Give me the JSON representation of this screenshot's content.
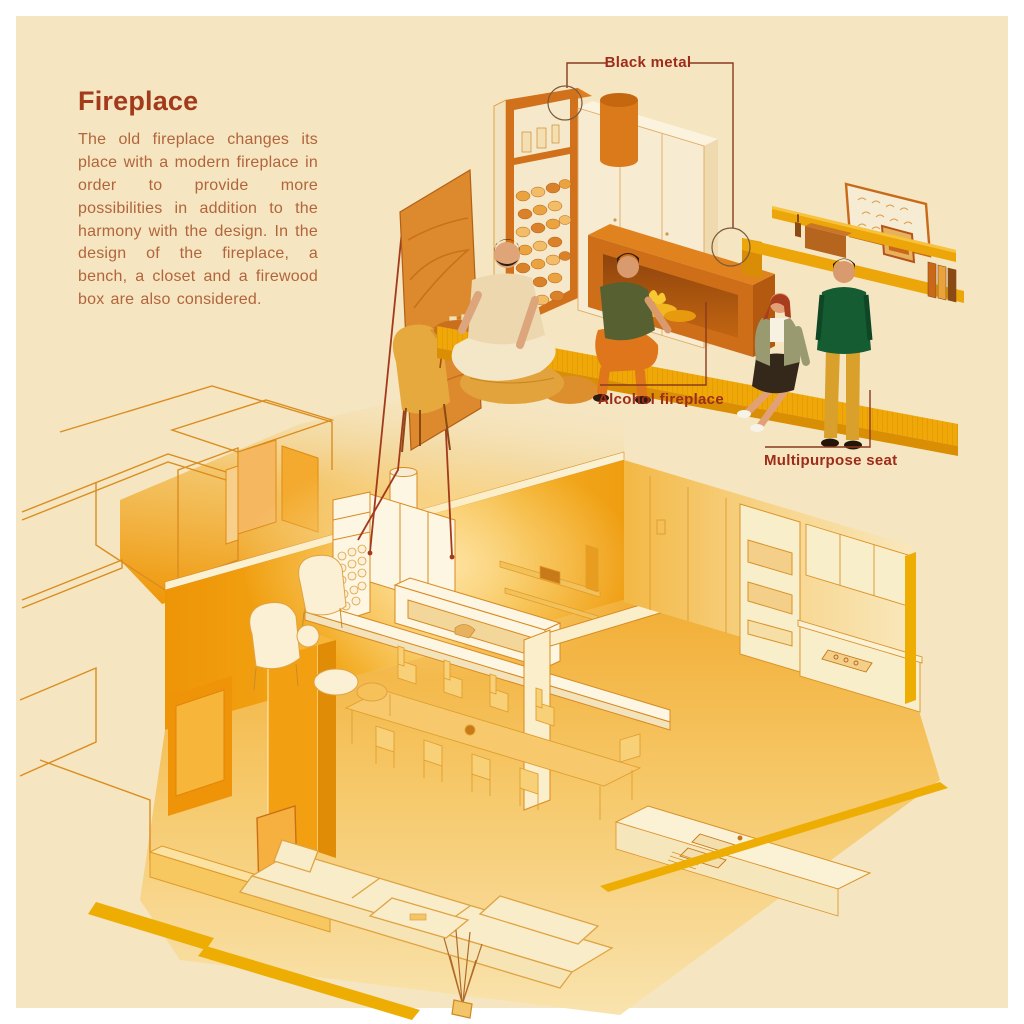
{
  "intro": {
    "title": "Fireplace",
    "body": "The old fireplace changes its place with a modern fireplace in order to provide more possibilities in addition to the harmony with the design. In the design of the fireplace, a bench, a closet and a firewood box are also considered."
  },
  "annotations": [
    {
      "id": "black-metal",
      "label": "Black metal"
    },
    {
      "id": "alcohol-fireplace",
      "label": "Alcohol fireplace"
    },
    {
      "id": "multipurpose-seat",
      "label": "Multipurpose seat"
    }
  ],
  "colors": {
    "frame": "#ffffff",
    "background": "#f5e5c0",
    "title_text": "#a23a1c",
    "body_text": "#b2653c",
    "label_text": "#9e2c1a",
    "callout_line": "#8a3a1e",
    "deep_orange": "#cf6e18",
    "mid_orange": "#e0831f",
    "bench_gold": "#efa807",
    "closet_cream": "#f7ecd2",
    "wall_orange": "#f2a617",
    "line_work": "#db8d1f",
    "highlight_white": "#fdf6e2",
    "sweater_green": "#155c33",
    "pants_mustard": "#d9a02c",
    "shirt_olive": "#566030",
    "pants_orange": "#e0761c"
  },
  "scene_parts": {
    "top": [
      "easel-painting",
      "lounge-chair",
      "side-table",
      "pouf",
      "sitting-man",
      "firewood-shelf",
      "closet",
      "chimney",
      "alcohol-fireplace-box",
      "bench",
      "crouching-man",
      "wall-shelves",
      "picture-frames",
      "sitting-woman",
      "standing-man"
    ],
    "bottom": [
      "apartment-cutaway",
      "outlined-rooms",
      "living-room-wall",
      "white-fireplace-unit",
      "white-bench",
      "tv-shelf",
      "entry-column",
      "dining-table",
      "dining-chairs",
      "armchairs",
      "kitchen-cabinets",
      "kitchen-island",
      "sofa",
      "coffee-table",
      "plant",
      "gold-floor-strips"
    ]
  }
}
